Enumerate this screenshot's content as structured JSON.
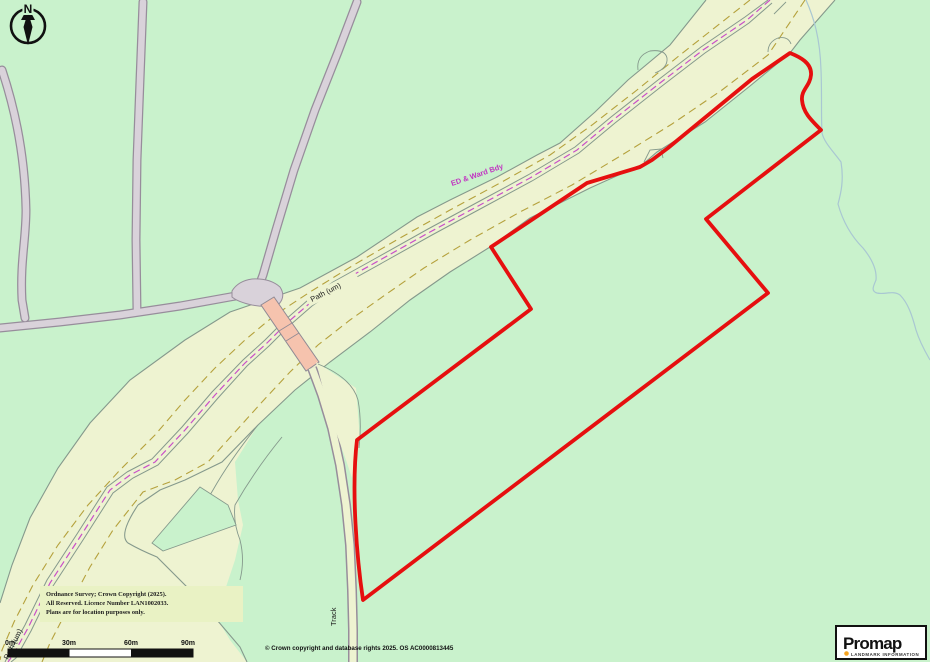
{
  "document": {
    "kind": "Ordnance Survey location plan (Promap print)"
  },
  "compass": {
    "north_label": "N"
  },
  "map_labels": {
    "ed_ward_bdy": "ED & Ward Bdy",
    "path_main": "Path (um)",
    "path_corner": "Path (um)",
    "track": "Track"
  },
  "scale_bar": {
    "labels": [
      "0m",
      "30m",
      "60m",
      "90m"
    ]
  },
  "copyright_box": {
    "line1": "Ordnance Survey; Crown Copyright (2025).",
    "line2": "All Reserved.  Licence Number LAN1002033.",
    "line3": "Plans are for location purposes only."
  },
  "footer": {
    "text": "© Crown copyright and database rights 2025. OS AC0000813445"
  },
  "logo": {
    "brand": "Promap",
    "tagline": "LANDMARK INFORMATION"
  },
  "colors": {
    "background_green": "#c9f2cc",
    "road_cream": "#eef3d1",
    "field_line": "#85998c",
    "olive_dash": "#b5a13c",
    "ward_boundary_magenta": "#c94fc9",
    "minor_road_fill": "#d9d2da",
    "minor_road_edge": "#978d9b",
    "bridge_salmon": "#f6c3ae",
    "site_boundary_red": "#e60f0f",
    "stream_blue": "#a9c7d2",
    "copyright_box_fill": "#e9f2c4",
    "logo_dot_orange": "#f5a31e",
    "ink": "#111111"
  }
}
